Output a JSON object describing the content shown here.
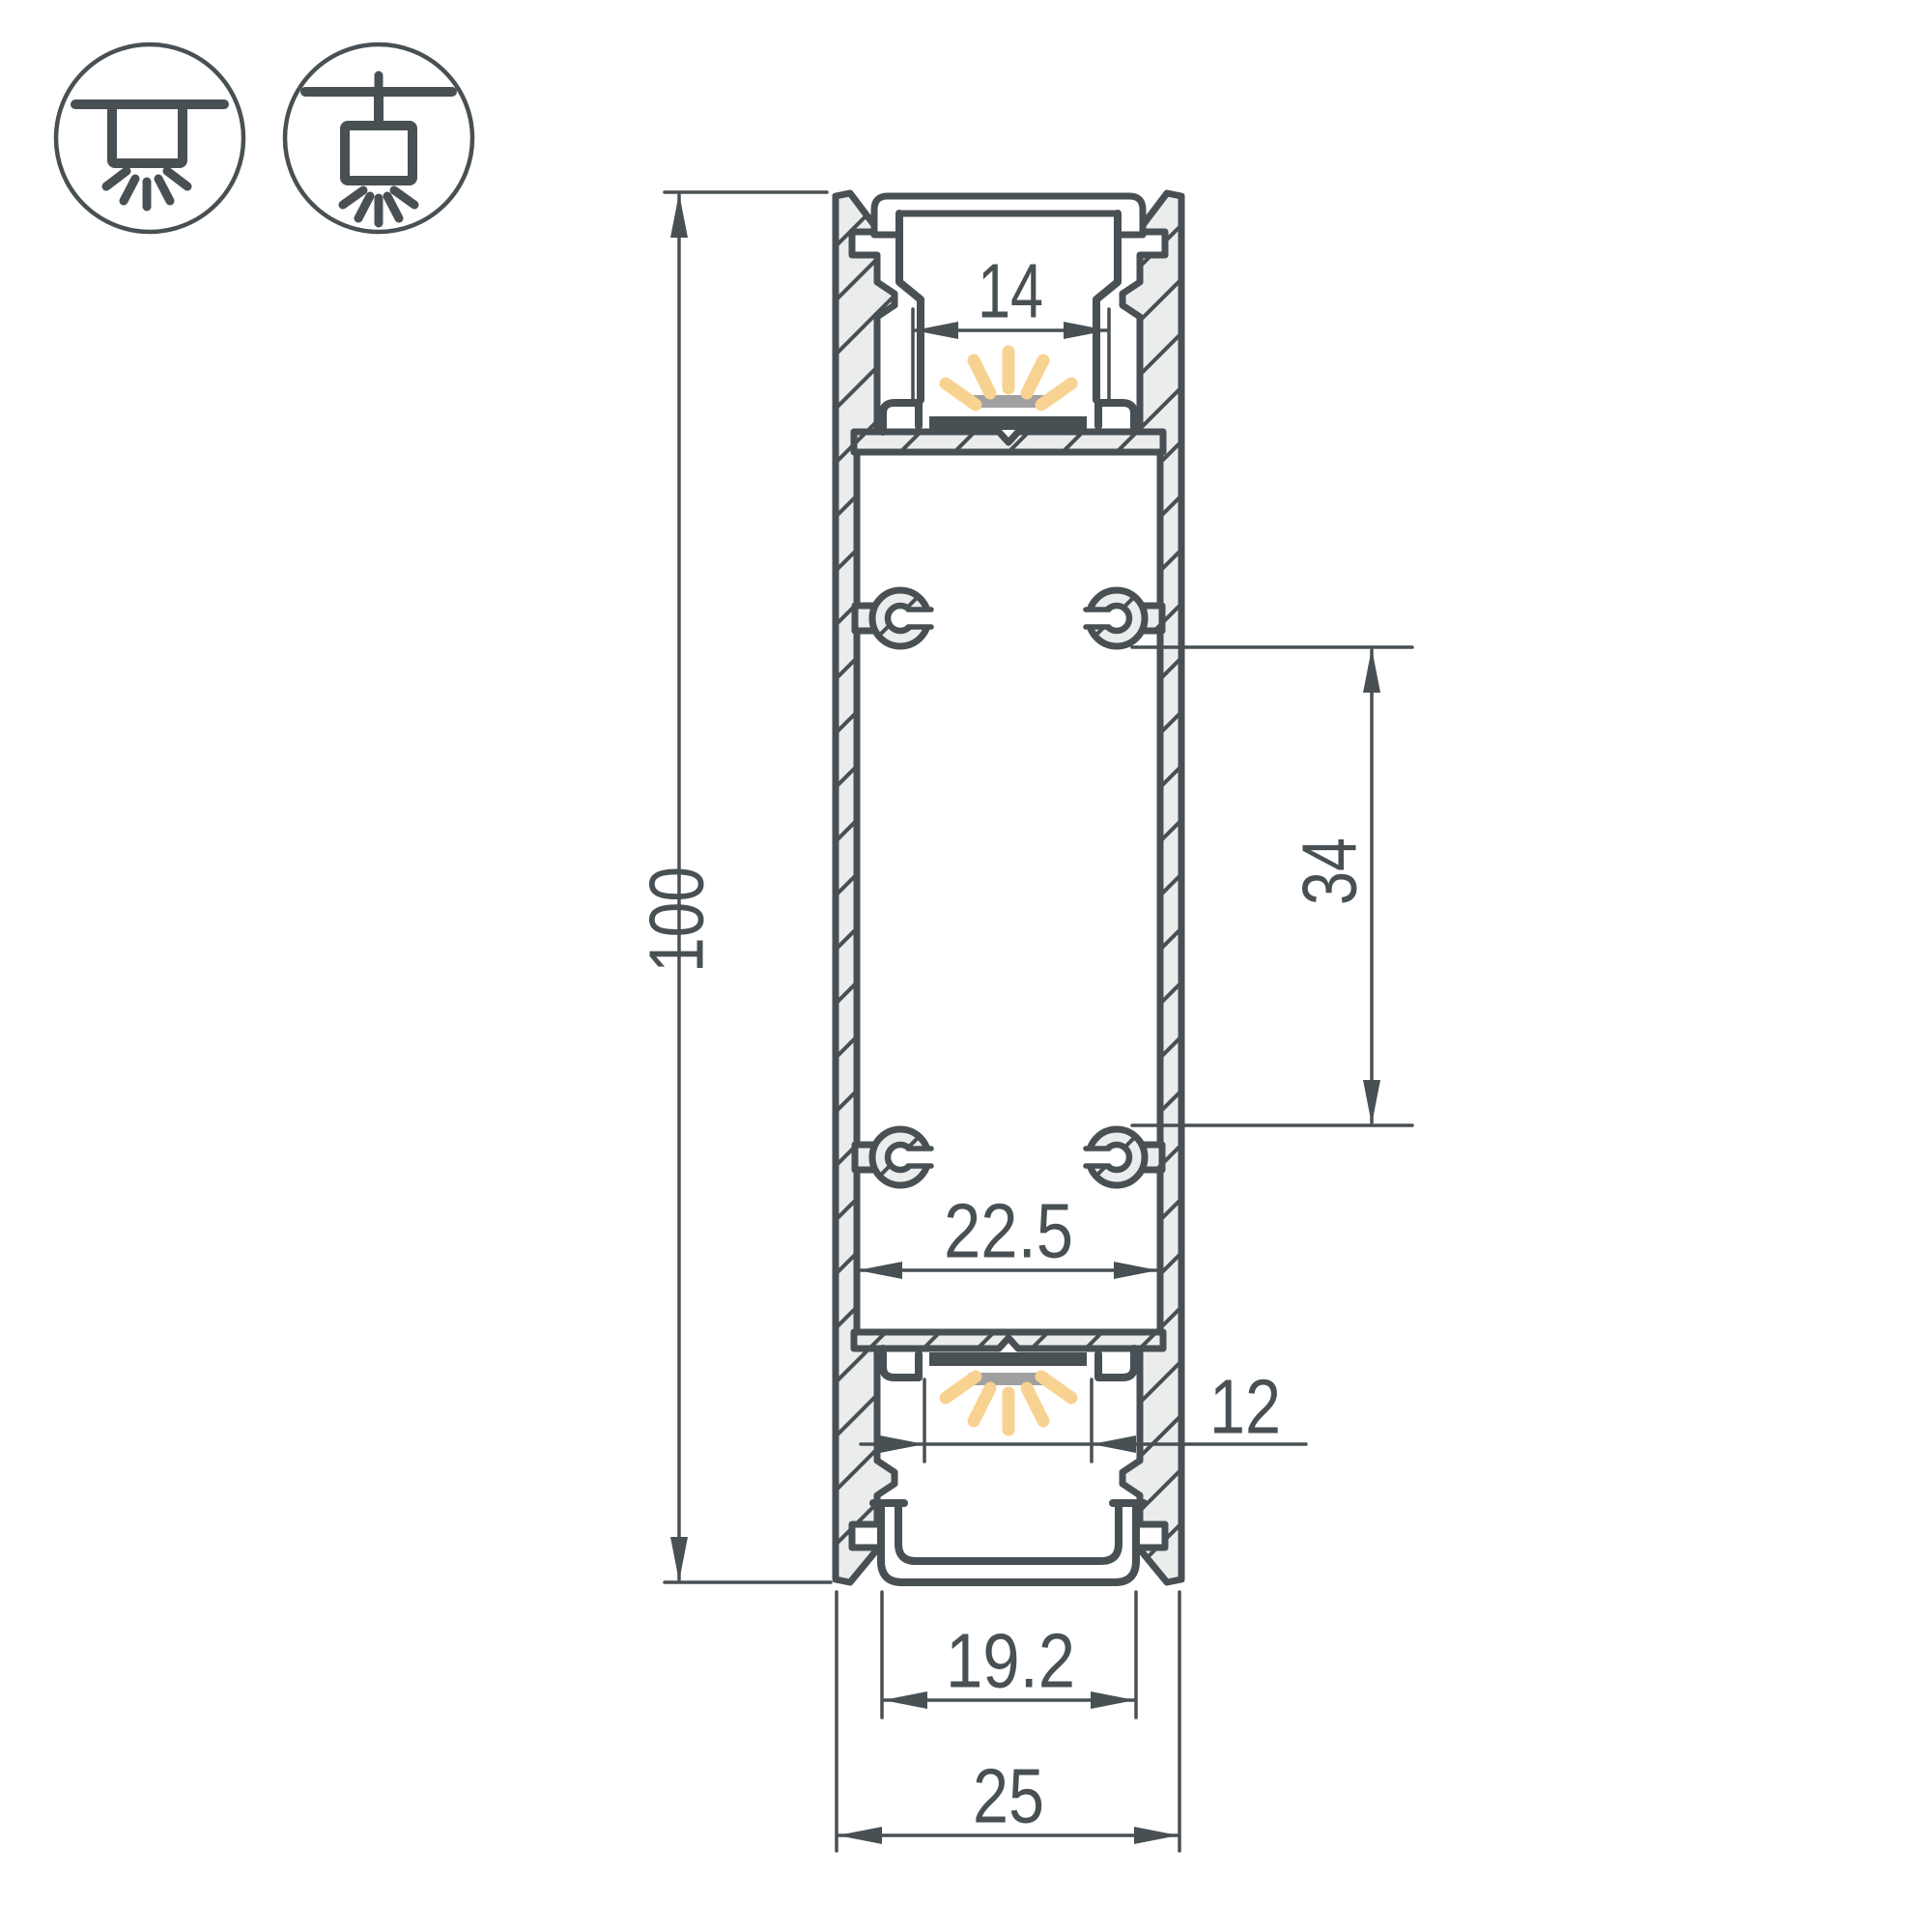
{
  "drawing": {
    "title": "LED aluminium profile cross-section",
    "mount_icons": {
      "surface": {
        "name": "surface-ceiling-mount-icon"
      },
      "pendant": {
        "name": "pendant-suspended-mount-icon"
      }
    },
    "dimensions": {
      "height": {
        "label": "100",
        "orientation": "vertical"
      },
      "top_opening": {
        "label": "14",
        "orientation": "horizontal"
      },
      "boss_spacing": {
        "label": "34",
        "orientation": "vertical"
      },
      "inner_width": {
        "label": "22.5",
        "orientation": "horizontal"
      },
      "bottom_opening": {
        "label": "12",
        "orientation": "horizontal"
      },
      "diffuser_width": {
        "label": "19.2",
        "orientation": "horizontal"
      },
      "overall_width": {
        "label": "25",
        "orientation": "horizontal"
      }
    },
    "colors": {
      "line": "#495054",
      "hatch": "#ebecec",
      "led": "#a0a0a0",
      "pcb": "#495054",
      "glow": "#f8d291",
      "background": "#ffffff"
    }
  }
}
